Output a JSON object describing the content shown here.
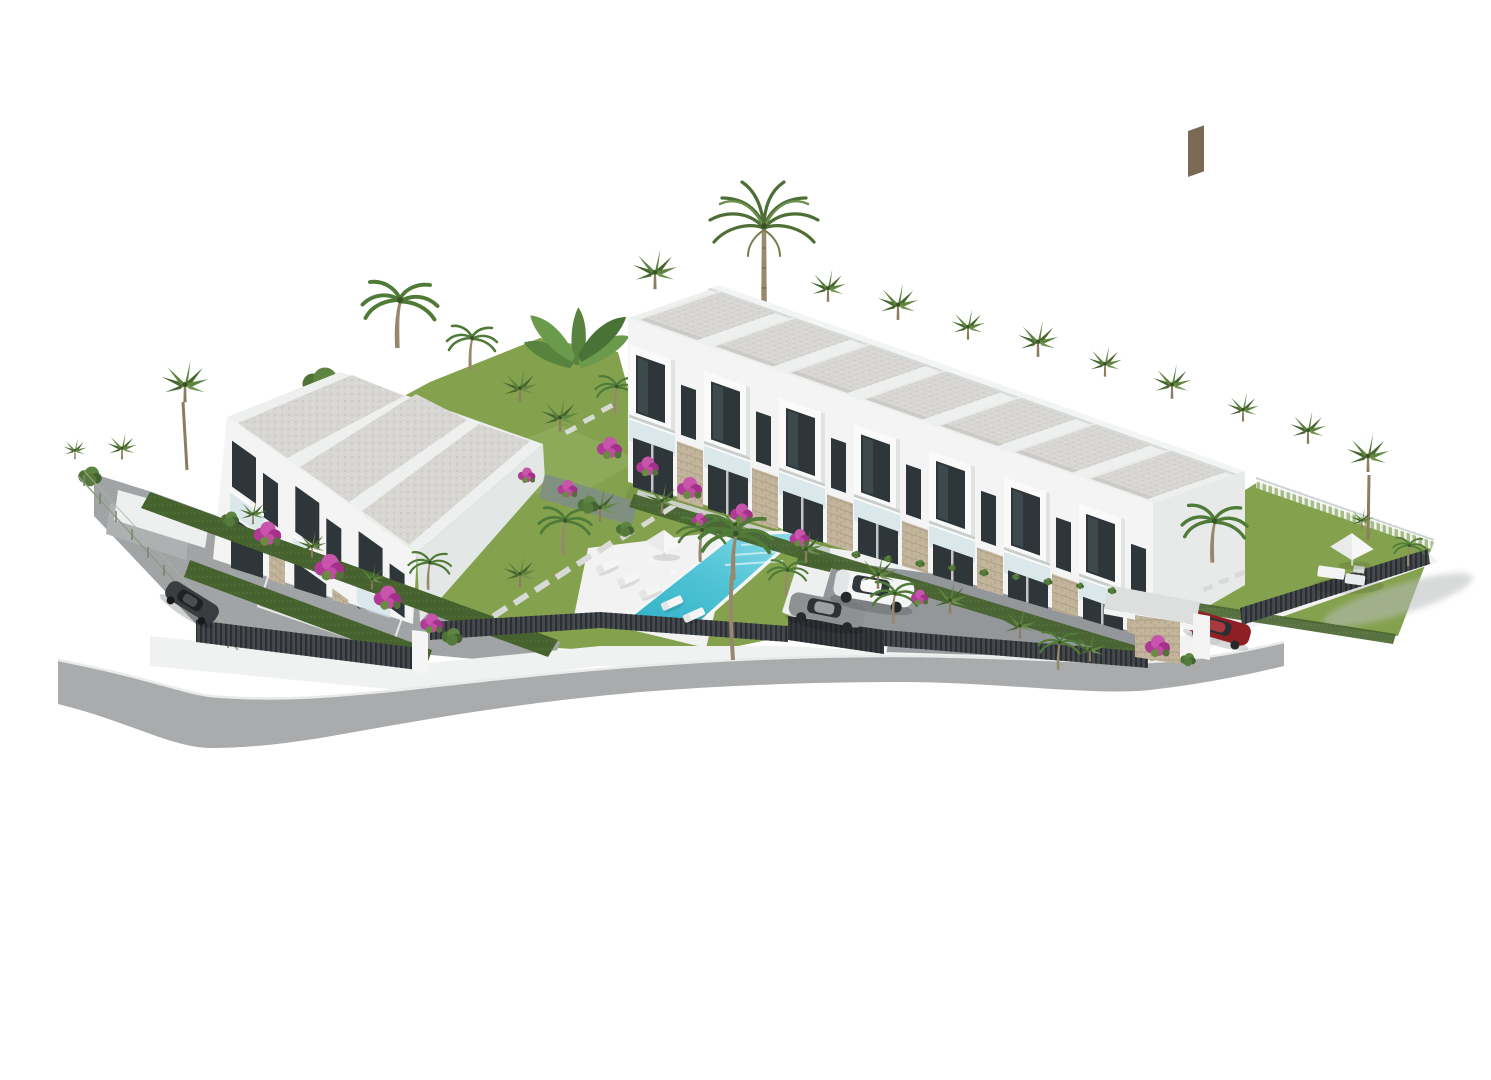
{
  "scene": {
    "type": "3d-architectural-render",
    "description": "Aerial rendering of a white modern townhouse development on a white background, with gardens, palm trees, bougainvillea, a turquoise pool with sun deck, a cobbled parking court with cars, perimeter walls with dark slatted fences and a curved road in front",
    "background": "#ffffff"
  },
  "buildings": {
    "left_block": {
      "label": "three-unit townhouse block",
      "units": 3,
      "floors": 2,
      "facade": "white",
      "roof": "flat gray gravel panels with white parapets"
    },
    "right_block": {
      "label": "seven-unit townhouse row",
      "units": 7,
      "floors": 2,
      "facade": "white with stone-clad ground piers and glass balconies",
      "roof": "stepped flat gray gravel panels"
    }
  },
  "site": {
    "pool": {
      "label": "swimming pool",
      "shape": "rectangular, angled",
      "steps": 3
    },
    "sun_deck": {
      "label": "white pool deck",
      "loungers": 5,
      "parasols": 1,
      "side_tables": 2
    },
    "parking_court": {
      "label": "cobbled parking court",
      "cars_parked": 2,
      "walls": "white retaining walls with trailing plants"
    },
    "carport": {
      "label": "gray canopy carport with stone pillar and bougainvillea",
      "cars": 1
    },
    "driveway": {
      "label": "left cobbled driveway with marked bay",
      "cars": 1
    },
    "private_lawn": {
      "label": "right corner lawn",
      "furniture": "white parasol with lounge set",
      "fences": "white picket above, dark slatted fence on curved white wall below"
    },
    "perimeter": {
      "label": "white walls with dark slatted fence segments, wire mesh fence on the left, curved road along the bottom"
    }
  },
  "vehicles": [
    {
      "label": "white SUV",
      "location": "parking court"
    },
    {
      "label": "gray sedan",
      "location": "parking court"
    },
    {
      "label": "dark red car",
      "location": "carport"
    },
    {
      "label": "dark gray car",
      "location": "left driveway"
    }
  ],
  "vegetation": {
    "tall_center_palm": 1,
    "fan_palms": 24,
    "coconut_palms": 9,
    "banana_cluster": 1,
    "bougainvillea_shrubs": 14,
    "hedges": "bright thuja hedges along facades and driveway",
    "lawns": 4
  },
  "colors": {
    "background": "#ffffff",
    "facade_white": "#f3f4f3",
    "facade_shade": "#e7eae9",
    "roof_gray": "#d7d6d2",
    "window_glass": "#2f363a",
    "stone_cladding": "#c3b59c",
    "balcony_glass": "#cfe1e7",
    "lawn_green": "#84a24d",
    "hedge_green": "#4e6b33",
    "palm_green": "#5f8440",
    "palm_dark": "#46652f",
    "trunk_brown": "#8d7d60",
    "bougainvillea_magenta": "#b03a96",
    "pool_water": "#4ec4d6",
    "pool_deck": "#f1f2f1",
    "driveway_paving": "#a3a6a8",
    "parking_paving": "#94989b",
    "road_asphalt": "#a9abac",
    "fence_dark": "#45494d",
    "wall_white": "#f0f2f1",
    "car_white": "#f4f5f5",
    "car_gray": "#8e9092",
    "car_dark": "#3a3d40",
    "car_red": "#8e2024"
  }
}
